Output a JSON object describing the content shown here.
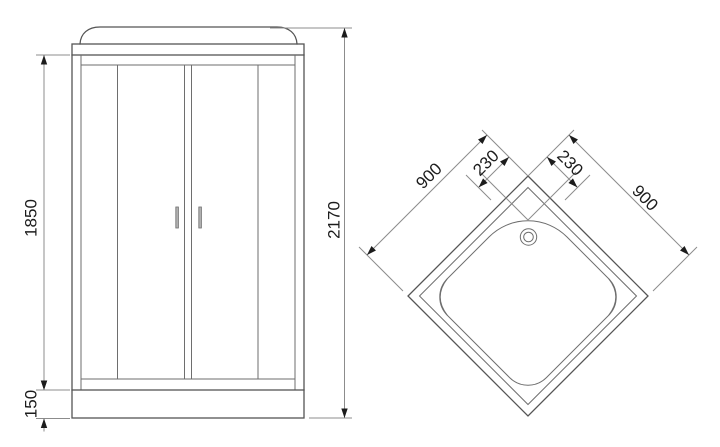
{
  "front_view": {
    "dims": {
      "glass_height": "1850",
      "tray_height": "150",
      "total_height": "2170"
    }
  },
  "top_view": {
    "dims": {
      "left_edge": "900",
      "right_edge": "900",
      "left_offset": "230",
      "right_offset": "230"
    }
  },
  "colors": {
    "outline": "#555555",
    "dimension_line": "#8c8c8c",
    "label_text": "#1c1c1c",
    "handle": "#b0b0b0",
    "background": "#ffffff"
  }
}
